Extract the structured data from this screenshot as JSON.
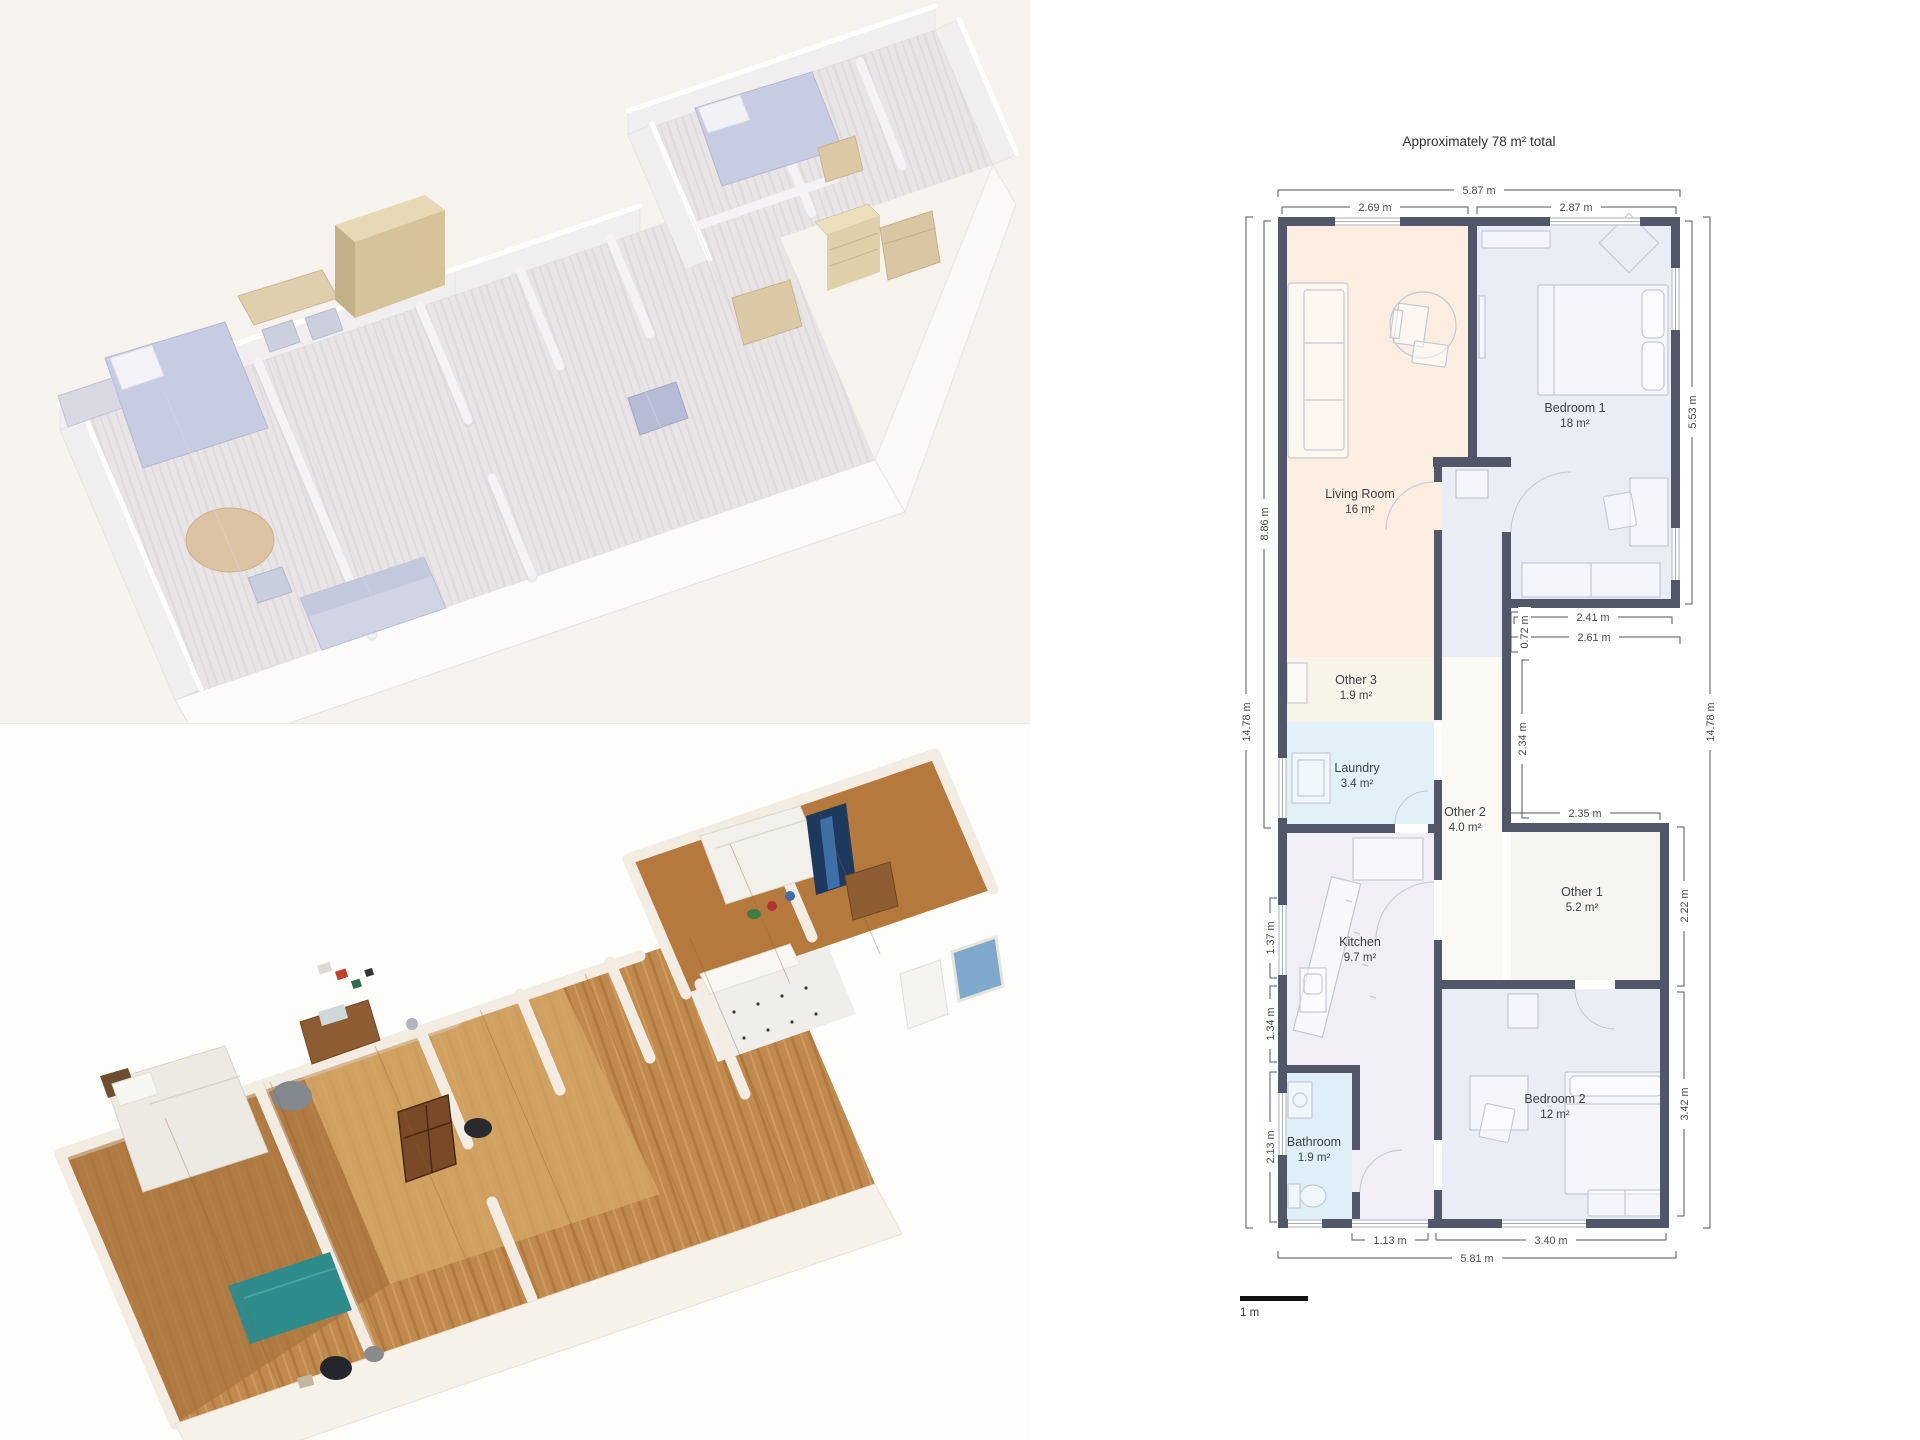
{
  "colors": {
    "wall": "#515669",
    "dim-line": "#55565e",
    "dim-text": "#47474b",
    "room-text": "#3d3f45",
    "room-living": "#fbeee1",
    "room-bedroom": "#e9edf6",
    "room-other3": "#f9f4e9",
    "room-laundry": "#e2f1f8",
    "room-hall": "#faf9f3",
    "room-kitchen": "#f1eef6",
    "room-bath": "#dfeff7",
    "room-other1": "#f6f5f0",
    "furniture-stroke": "#c3c9d7",
    "panel-top-bg": "#f6f2ee",
    "panel-bottom-bg": "#fdfdfb",
    "plan-bg": "#ffffff",
    "model-beige": "#d9c7a6",
    "model-lavender": "#c8cce3",
    "scan-wood": "#c08a4e",
    "scan-teal": "#2e8b8b"
  },
  "floor_plan": {
    "title": "Approximately 78 m² total",
    "scale_label": "1 m",
    "rooms": [
      {
        "name": "Living Room",
        "area": "16 m²"
      },
      {
        "name": "Bedroom 1",
        "area": "18 m²"
      },
      {
        "name": "Other 3",
        "area": "1.9 m²"
      },
      {
        "name": "Laundry",
        "area": "3.4 m²"
      },
      {
        "name": "Other 2",
        "area": "4.0 m²"
      },
      {
        "name": "Other 1",
        "area": "5.2 m²"
      },
      {
        "name": "Kitchen",
        "area": "9.7 m²"
      },
      {
        "name": "Bathroom",
        "area": "1.9 m²"
      },
      {
        "name": "Bedroom 2",
        "area": "12 m²"
      }
    ],
    "dimensions": {
      "top_total": "5.87 m",
      "top_living": "2.69 m",
      "top_bedroom1": "2.87 m",
      "right_bedroom1": "5.53 m",
      "right_total": "14.78 m",
      "left_living": "8.86 m",
      "left_total": "14.78 m",
      "notch_inner": "2.41 m",
      "notch_outer": "2.61 m",
      "notch_step": "0.72 m",
      "corridor_side": "2.34 m",
      "other1_width": "2.35 m",
      "other1_height": "2.22 m",
      "kitchen_recess": "1.37 m",
      "kitchen_lower": "1.34 m",
      "bathroom_side": "2.13 m",
      "bedroom2_height": "3.42 m",
      "bottom_left": "1.13 m",
      "bottom_right": "3.40 m",
      "bottom_total": "5.81 m"
    }
  }
}
